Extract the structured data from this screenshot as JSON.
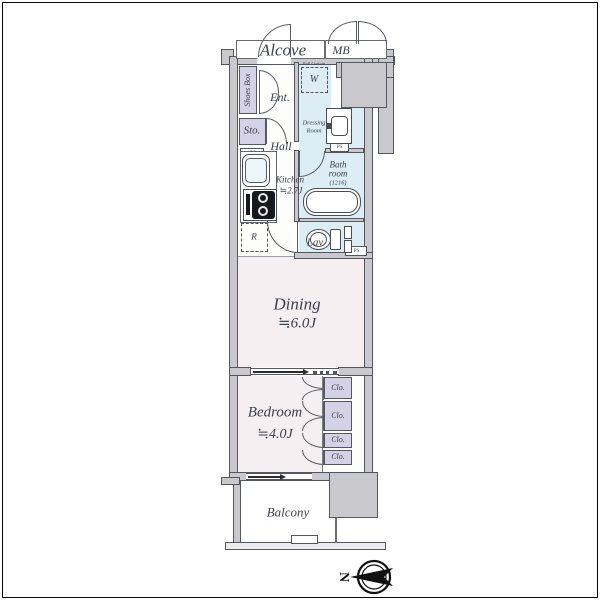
{
  "plan": {
    "rooms": {
      "alcove": {
        "label": "Alcove"
      },
      "meter_box": {
        "label": "MB"
      },
      "shoes_box": {
        "label": "Shoes Box"
      },
      "entrance": {
        "label": "Ent."
      },
      "washing_machine_space": {
        "label": "W",
        "note": "Roll Curtain"
      },
      "storage": {
        "label": "Sto."
      },
      "hall": {
        "label": "Hall"
      },
      "dressing_room": {
        "line1": "Dressing",
        "line2": "Room"
      },
      "kitchen": {
        "label": "Kitchen",
        "size": "≒2.7J"
      },
      "bathroom": {
        "line1": "Bath",
        "line2": "room",
        "size": "(1216)"
      },
      "lavatory": {
        "label": "Lav."
      },
      "refrigerator_space": {
        "label": "R"
      },
      "dining": {
        "label": "Dining",
        "size": "≒6.0J"
      },
      "bedroom": {
        "label": "Bedroom",
        "size": "≒4.0J"
      },
      "closets": [
        {
          "label": "Clo."
        },
        {
          "label": "Clo."
        },
        {
          "label": "Clo."
        },
        {
          "label": "Clo."
        }
      ],
      "balcony": {
        "label": "Balcony"
      }
    },
    "pipe_shafts": [
      {
        "label": "PS"
      },
      {
        "label": "PS"
      },
      {
        "label": "PS"
      }
    ],
    "compass": {
      "north_label": "N"
    },
    "palette": {
      "wall_fill": "#c9c9cd",
      "wall_outline": "#55575e",
      "wet_area": "#dcedf5",
      "living_area": "#f5eff1",
      "storage_area": "#d5d1e6",
      "label_text": "#3d414c"
    }
  }
}
